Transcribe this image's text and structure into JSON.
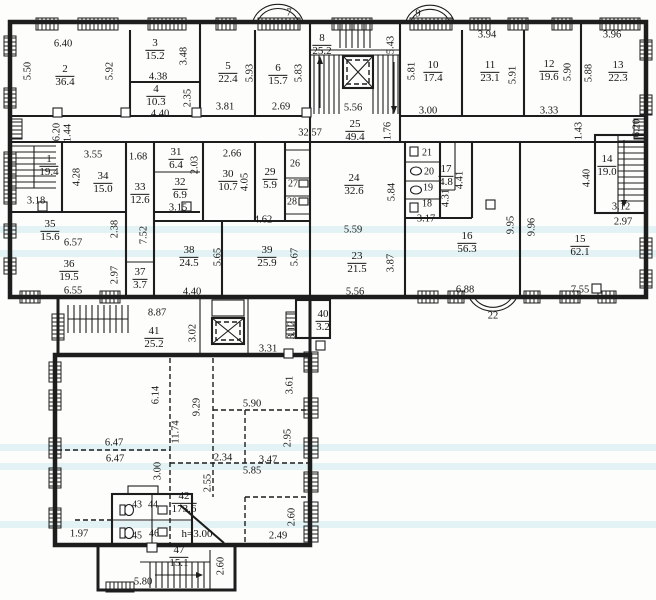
{
  "drawing": {
    "kind_label": "floor plan",
    "height_note": "h=3.00"
  },
  "colors": {
    "line": "#1d1d1d",
    "paper": "#fdfdfb",
    "scan_band": "#96d4e0"
  },
  "rooms": [
    {
      "number": "1",
      "area": "19.4",
      "x": 49,
      "y": 166
    },
    {
      "number": "2",
      "area": "36.4",
      "x": 65,
      "y": 76
    },
    {
      "number": "3",
      "area": "15.2",
      "x": 155,
      "y": 50
    },
    {
      "number": "4",
      "area": "10.3",
      "x": 156,
      "y": 96
    },
    {
      "number": "5",
      "area": "22.4",
      "x": 228,
      "y": 73
    },
    {
      "number": "6",
      "area": "15.7",
      "x": 278,
      "y": 75
    },
    {
      "number": "8",
      "area": "25.2",
      "x": 322,
      "y": 45
    },
    {
      "number": "10",
      "area": "17.4",
      "x": 433,
      "y": 72
    },
    {
      "number": "11",
      "area": "23.1",
      "x": 490,
      "y": 72
    },
    {
      "number": "12",
      "area": "19.6",
      "x": 549,
      "y": 71
    },
    {
      "number": "13",
      "area": "22.3",
      "x": 618,
      "y": 72
    },
    {
      "number": "14",
      "area": "19.0",
      "x": 607,
      "y": 166
    },
    {
      "number": "15",
      "area": "62.1",
      "x": 580,
      "y": 246
    },
    {
      "number": "16",
      "area": "56.3",
      "x": 467,
      "y": 243
    },
    {
      "number": "17",
      "area": "4.8",
      "x": 446,
      "y": 176
    },
    {
      "number": "23",
      "area": "21.5",
      "x": 357,
      "y": 263
    },
    {
      "number": "24",
      "area": "32.6",
      "x": 354,
      "y": 185
    },
    {
      "number": "25",
      "area": "49.4",
      "x": 355,
      "y": 131
    },
    {
      "number": "29",
      "area": "5.9",
      "x": 270,
      "y": 179
    },
    {
      "number": "30",
      "area": "10.7",
      "x": 228,
      "y": 181
    },
    {
      "number": "31",
      "area": "6.4",
      "x": 176,
      "y": 159
    },
    {
      "number": "32",
      "area": "6.9",
      "x": 180,
      "y": 189
    },
    {
      "number": "33",
      "area": "12.6",
      "x": 140,
      "y": 194
    },
    {
      "number": "34",
      "area": "15.0",
      "x": 103,
      "y": 183
    },
    {
      "number": "35",
      "area": "15.6",
      "x": 50,
      "y": 231
    },
    {
      "number": "36",
      "area": "19.5",
      "x": 69,
      "y": 271
    },
    {
      "number": "37",
      "area": "3.7",
      "x": 140,
      "y": 279
    },
    {
      "number": "38",
      "area": "24.5",
      "x": 189,
      "y": 257
    },
    {
      "number": "39",
      "area": "25.9",
      "x": 267,
      "y": 257
    },
    {
      "number": "40",
      "area": "3.2",
      "x": 323,
      "y": 321
    },
    {
      "number": "41",
      "area": "25.2",
      "x": 154,
      "y": 338
    },
    {
      "number": "42",
      "area": "173.6",
      "x": 184,
      "y": 503
    },
    {
      "number": "47",
      "area": "15.1",
      "x": 179,
      "y": 557
    }
  ],
  "cells": [
    {
      "number": "18",
      "x": 427,
      "y": 204
    },
    {
      "number": "19",
      "x": 428,
      "y": 188
    },
    {
      "number": "20",
      "x": 429,
      "y": 172
    },
    {
      "number": "21",
      "x": 427,
      "y": 153
    },
    {
      "number": "26",
      "x": 295,
      "y": 164
    },
    {
      "number": "27",
      "x": 293,
      "y": 184
    },
    {
      "number": "28",
      "x": 292,
      "y": 202
    },
    {
      "number": "43",
      "x": 137,
      "y": 505
    },
    {
      "number": "44",
      "x": 153,
      "y": 505
    },
    {
      "number": "45",
      "x": 137,
      "y": 536
    },
    {
      "number": "46",
      "x": 154,
      "y": 534
    }
  ],
  "balconies": [
    {
      "number": "7",
      "x": 289,
      "y": 13
    },
    {
      "number": "9",
      "x": 418,
      "y": 14
    },
    {
      "number": "22",
      "x": 493,
      "y": 316
    }
  ],
  "dimensions": [
    {
      "text": "6.40",
      "x": 63,
      "y": 44,
      "rot": 0
    },
    {
      "text": "4.38",
      "x": 158,
      "y": 77,
      "rot": 0
    },
    {
      "text": "4.40",
      "x": 160,
      "y": 114,
      "rot": 0
    },
    {
      "text": "3.81",
      "x": 225,
      "y": 107,
      "rot": 0
    },
    {
      "text": "2.69",
      "x": 281,
      "y": 107,
      "rot": 0
    },
    {
      "text": "5.56",
      "x": 353,
      "y": 108,
      "rot": 0
    },
    {
      "text": "3.94",
      "x": 487,
      "y": 35,
      "rot": 0
    },
    {
      "text": "3.96",
      "x": 612,
      "y": 35,
      "rot": 0
    },
    {
      "text": "3.00",
      "x": 428,
      "y": 111,
      "rot": 0
    },
    {
      "text": "3.33",
      "x": 549,
      "y": 111,
      "rot": 0
    },
    {
      "text": "32.57",
      "x": 310,
      "y": 133,
      "rot": 0
    },
    {
      "text": "3.55",
      "x": 93,
      "y": 155,
      "rot": 0
    },
    {
      "text": "1.68",
      "x": 138,
      "y": 157,
      "rot": 0
    },
    {
      "text": "3.18",
      "x": 36,
      "y": 201,
      "rot": 0
    },
    {
      "text": "2.66",
      "x": 232,
      "y": 154,
      "rot": 0
    },
    {
      "text": "3.15",
      "x": 178,
      "y": 208,
      "rot": 0
    },
    {
      "text": "6.57",
      "x": 73,
      "y": 243,
      "rot": 0
    },
    {
      "text": "6.55",
      "x": 73,
      "y": 291,
      "rot": 0
    },
    {
      "text": "4.40",
      "x": 192,
      "y": 292,
      "rot": 0
    },
    {
      "text": "4.62",
      "x": 263,
      "y": 220,
      "rot": 0
    },
    {
      "text": "3.17",
      "x": 426,
      "y": 219,
      "rot": 0
    },
    {
      "text": "5.59",
      "x": 353,
      "y": 230,
      "rot": 0
    },
    {
      "text": "5.56",
      "x": 355,
      "y": 292,
      "rot": 0
    },
    {
      "text": "6.88",
      "x": 465,
      "y": 290,
      "rot": 0
    },
    {
      "text": "7.55",
      "x": 580,
      "y": 290,
      "rot": 0
    },
    {
      "text": "3.12",
      "x": 621,
      "y": 207,
      "rot": 0
    },
    {
      "text": "2.97",
      "x": 623,
      "y": 222,
      "rot": 0
    },
    {
      "text": "8.87",
      "x": 157,
      "y": 313,
      "rot": 0
    },
    {
      "text": "3.31",
      "x": 268,
      "y": 349,
      "rot": 0
    },
    {
      "text": "5.90",
      "x": 252,
      "y": 404,
      "rot": 0
    },
    {
      "text": "6.47",
      "x": 114,
      "y": 443,
      "rot": 0
    },
    {
      "text": "6.47",
      "x": 115,
      "y": 459,
      "rot": 0
    },
    {
      "text": "2.34",
      "x": 223,
      "y": 458,
      "rot": 0
    },
    {
      "text": "3.47",
      "x": 268,
      "y": 460,
      "rot": 0
    },
    {
      "text": "5.85",
      "x": 252,
      "y": 471,
      "rot": 0
    },
    {
      "text": "2.49",
      "x": 278,
      "y": 536,
      "rot": 0
    },
    {
      "text": "1.97",
      "x": 79,
      "y": 534,
      "rot": 0
    },
    {
      "text": "5.80",
      "x": 143,
      "y": 582,
      "rot": 0
    },
    {
      "text": "5.50",
      "x": 28,
      "y": 71,
      "rot": 1
    },
    {
      "text": "5.92",
      "x": 110,
      "y": 71,
      "rot": 1
    },
    {
      "text": "3.48",
      "x": 184,
      "y": 56,
      "rot": 1
    },
    {
      "text": "2.35",
      "x": 188,
      "y": 98,
      "rot": 1
    },
    {
      "text": "5.93",
      "x": 250,
      "y": 73,
      "rot": 1
    },
    {
      "text": "5.83",
      "x": 299,
      "y": 73,
      "rot": 1
    },
    {
      "text": "5.43",
      "x": 391,
      "y": 45,
      "rot": 1
    },
    {
      "text": "5.81",
      "x": 412,
      "y": 71,
      "rot": 1
    },
    {
      "text": "5.91",
      "x": 513,
      "y": 75,
      "rot": 1
    },
    {
      "text": "5.90",
      "x": 568,
      "y": 72,
      "rot": 1
    },
    {
      "text": "5.88",
      "x": 589,
      "y": 73,
      "rot": 1
    },
    {
      "text": "6.20",
      "x": 57,
      "y": 132,
      "rot": 1
    },
    {
      "text": "1.44",
      "x": 68,
      "y": 133,
      "rot": 1
    },
    {
      "text": "1.76",
      "x": 388,
      "y": 131,
      "rot": 1
    },
    {
      "text": "1.43",
      "x": 579,
      "y": 131,
      "rot": 1
    },
    {
      "text": "6.20",
      "x": 637,
      "y": 128,
      "rot": 1
    },
    {
      "text": "4.28",
      "x": 77,
      "y": 177,
      "rot": 1
    },
    {
      "text": "2.03",
      "x": 195,
      "y": 165,
      "rot": 1
    },
    {
      "text": "4.05",
      "x": 245,
      "y": 182,
      "rot": 1
    },
    {
      "text": "2.38",
      "x": 115,
      "y": 229,
      "rot": 1
    },
    {
      "text": "7.52",
      "x": 144,
      "y": 235,
      "rot": 1
    },
    {
      "text": "2.97",
      "x": 115,
      "y": 275,
      "rot": 1
    },
    {
      "text": "5.65",
      "x": 218,
      "y": 257,
      "rot": 1
    },
    {
      "text": "5.67",
      "x": 295,
      "y": 257,
      "rot": 1
    },
    {
      "text": "5.84",
      "x": 392,
      "y": 192,
      "rot": 1
    },
    {
      "text": "4.41",
      "x": 460,
      "y": 180,
      "rot": 1
    },
    {
      "text": "4.31",
      "x": 446,
      "y": 198,
      "rot": 1
    },
    {
      "text": "3.87",
      "x": 391,
      "y": 263,
      "rot": 1
    },
    {
      "text": "4.40",
      "x": 587,
      "y": 178,
      "rot": 1
    },
    {
      "text": "9.95",
      "x": 511,
      "y": 225,
      "rot": 1
    },
    {
      "text": "9.96",
      "x": 532,
      "y": 227,
      "rot": 1
    },
    {
      "text": "3.02",
      "x": 193,
      "y": 333,
      "rot": 1
    },
    {
      "text": "3.12",
      "x": 292,
      "y": 330,
      "rot": 1
    },
    {
      "text": "3.61",
      "x": 290,
      "y": 385,
      "rot": 1
    },
    {
      "text": "6.14",
      "x": 156,
      "y": 395,
      "rot": 1
    },
    {
      "text": "9.29",
      "x": 197,
      "y": 407,
      "rot": 1
    },
    {
      "text": "11.74",
      "x": 176,
      "y": 432,
      "rot": 1
    },
    {
      "text": "3.00",
      "x": 158,
      "y": 471,
      "rot": 1
    },
    {
      "text": "2.55",
      "x": 208,
      "y": 483,
      "rot": 1
    },
    {
      "text": "2.95",
      "x": 288,
      "y": 438,
      "rot": 1
    },
    {
      "text": "2.60",
      "x": 292,
      "y": 517,
      "rot": 1
    },
    {
      "text": "2.60",
      "x": 221,
      "y": 566,
      "rot": 1
    }
  ],
  "annotations": [
    {
      "text": "h=3.00",
      "x": 197,
      "y": 534
    }
  ]
}
